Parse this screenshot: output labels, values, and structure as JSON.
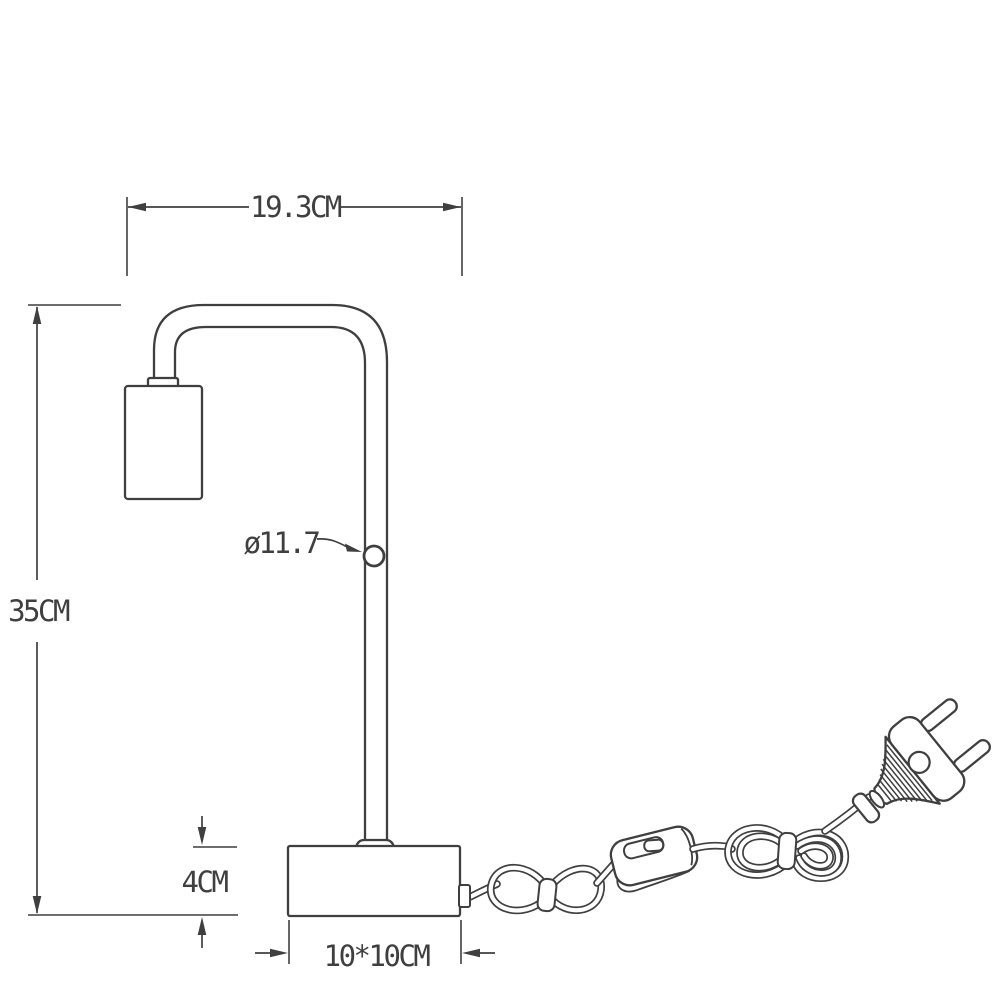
{
  "drawing": {
    "background": "#ffffff",
    "line_color": "#3f3f3f",
    "labels": {
      "width": "19.3CM",
      "height": "35CM",
      "pole_diameter": "ø11.7",
      "base_height": "4CM",
      "base_size": "10*10CM"
    }
  }
}
